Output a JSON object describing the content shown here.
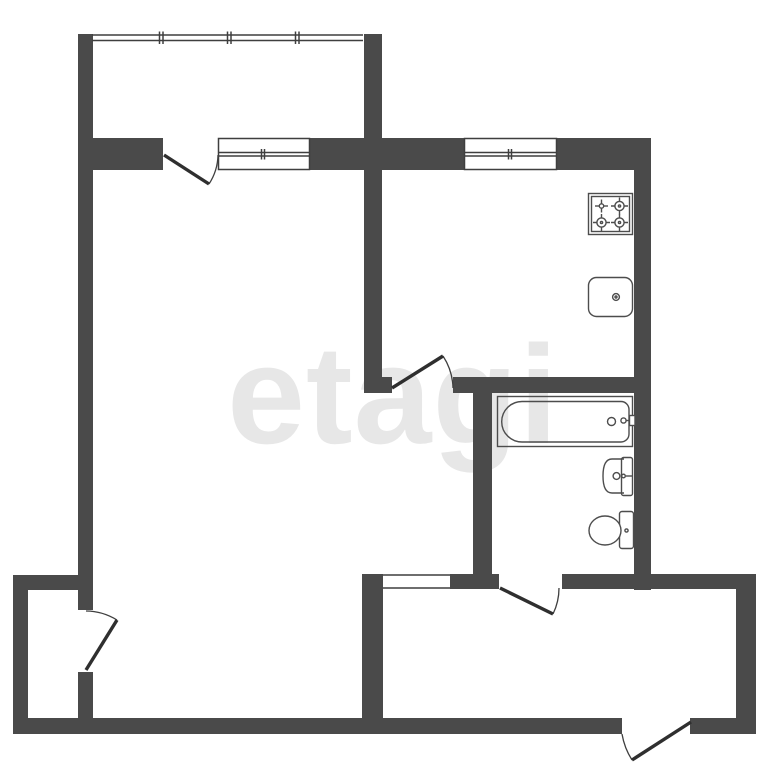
{
  "watermark": {
    "text": "etagi"
  },
  "colors": {
    "background": "#ffffff",
    "wall": "#4a4a4a",
    "outline": "#3f3f3f",
    "fixture": "#4d4d4d",
    "door_leaf": "#2f2f2f",
    "watermark": "#e7e7e7"
  },
  "plan": {
    "type": "floor-plan",
    "windows": [
      "living-room-window",
      "kitchen-window"
    ],
    "doors": [
      "balcony-door",
      "kitchen-door",
      "storage-door",
      "bathroom-door",
      "entrance-door"
    ],
    "openings": [
      "hallway-opening"
    ],
    "fixtures": [
      "stove",
      "kitchen-sink",
      "bathtub",
      "washbasin",
      "toilet"
    ],
    "balcony_railing_sections": 4
  }
}
